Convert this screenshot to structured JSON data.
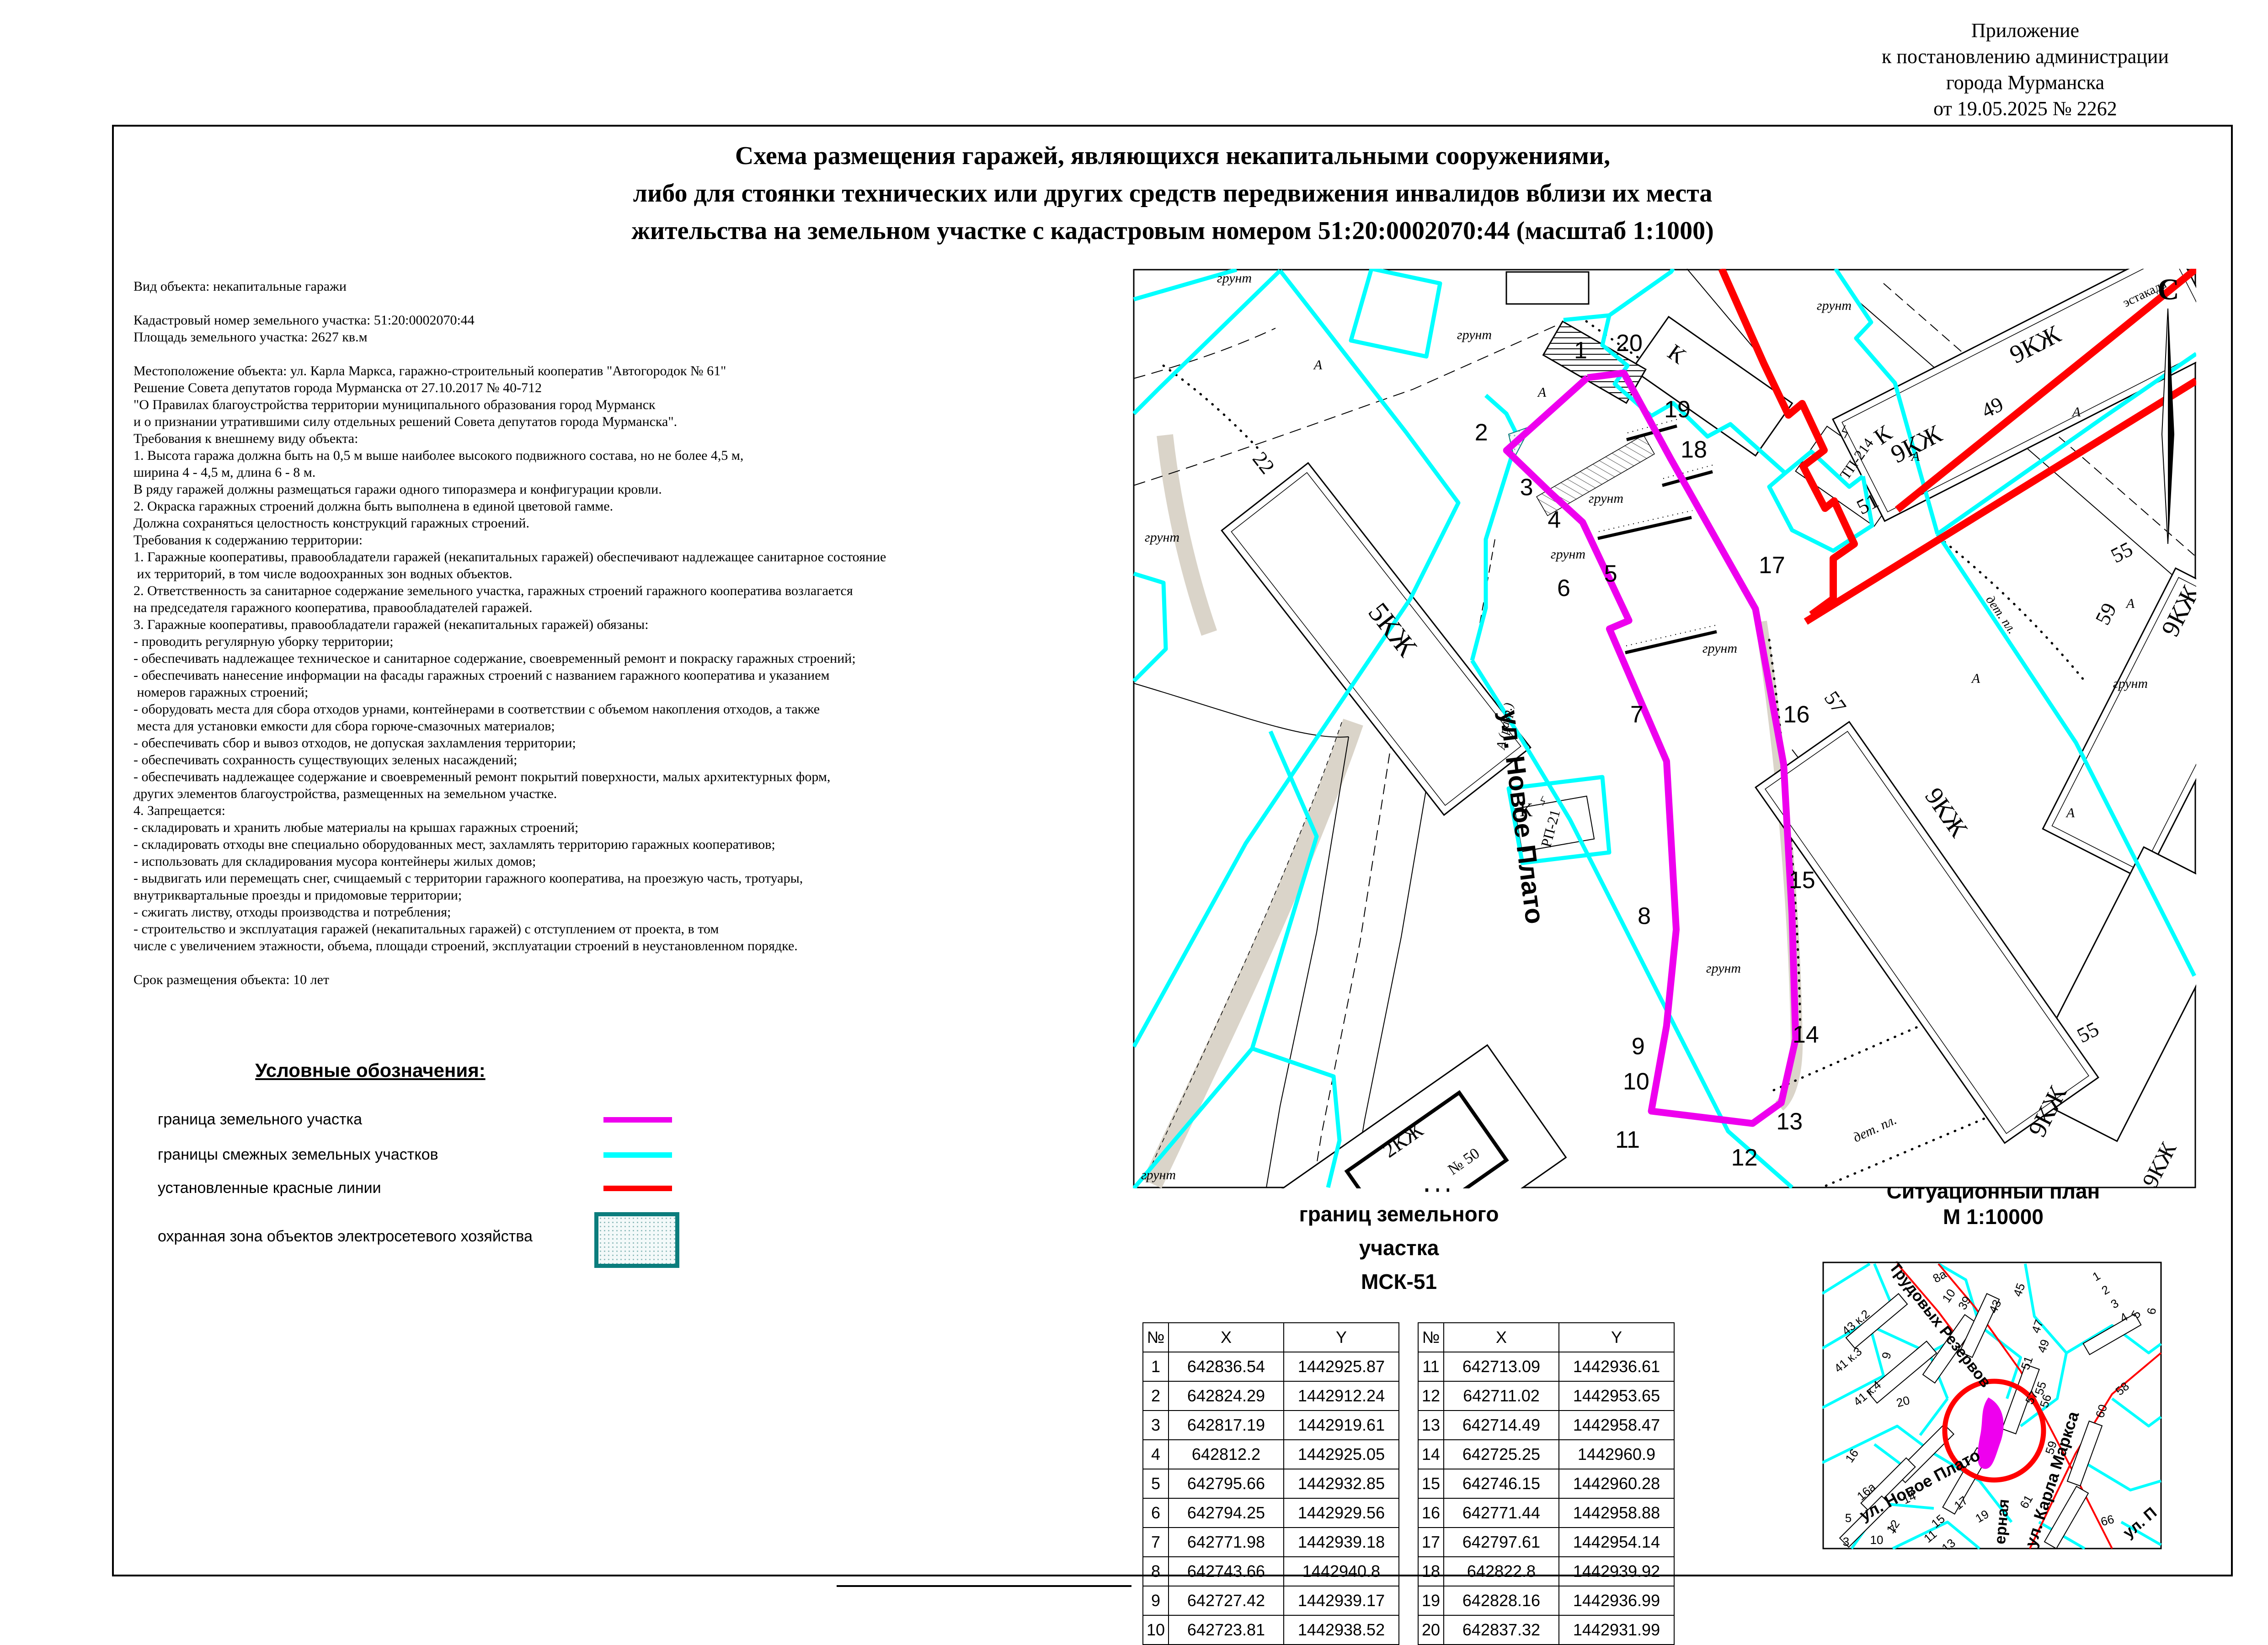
{
  "appendix": {
    "lines": [
      "Приложение",
      "к постановлению администрации",
      "города Мурманска",
      "от 19.05.2025 № 2262"
    ]
  },
  "title": {
    "lines": [
      "Схема размещения гаражей, являющихся некапитальными сооружениями,",
      "либо для стоянки технических или других средств передвижения инвалидов вблизи их места",
      "жительства на земельном участке с кадастровым номером 51:20:0002070:44 (масштаб 1:1000)"
    ]
  },
  "info_block": {
    "lines": [
      "Вид объекта: некапитальные гаражи",
      "",
      "Кадастровый номер земельного участка: 51:20:0002070:44",
      "Площадь земельного участка: 2627 кв.м",
      "",
      "Местоположение объекта: ул. Карла Маркса, гаражно-строительный кооператив \"Автогородок № 61\"",
      "Решение Совета депутатов города Мурманска от 27.10.2017 № 40-712",
      "\"О Правилах благоустройства территории муниципального образования город Мурманск",
      "и о признании утратившими силу отдельных решений Совета депутатов города Мурманска\".",
      "Требования к внешнему виду объекта:",
      "1. Высота гаража должна быть на 0,5 м выше наиболее высокого подвижного состава, но не более 4,5 м,",
      "ширина 4 - 4,5 м, длина 6 - 8 м.",
      "В ряду гаражей должны размещаться гаражи одного типоразмера и конфигурации кровли.",
      "2. Окраска гаражных строений должна быть выполнена в единой цветовой гамме.",
      "Должна сохраняться целостность конструкций гаражных строений.",
      "Требования к содержанию территории:",
      "1. Гаражные кооперативы, правообладатели гаражей (некапитальных гаражей) обеспечивают надлежащее санитарное состояние",
      " их территорий, в том числе водоохранных зон водных объектов.",
      "2. Ответственность за санитарное содержание земельного участка, гаражных строений гаражного кооператива возлагается",
      "на председателя гаражного кооператива, правообладателей гаражей.",
      "3. Гаражные кооперативы, правообладатели гаражей (некапитальных гаражей) обязаны:",
      "- проводить регулярную уборку территории;",
      "- обеспечивать надлежащее техническое и санитарное содержание, своевременный ремонт и покраску гаражных строений;",
      "- обеспечивать нанесение информации на фасады гаражных строений с названием гаражного кооператива и указанием",
      " номеров гаражных строений;",
      "- оборудовать места для сбора отходов урнами, контейнерами в соответствии с объемом накопления отходов, а также",
      " места для установки емкости для сбора горюче-смазочных материалов;",
      "- обеспечивать сбор и вывоз отходов, не допуская захламления территории;",
      "- обеспечивать сохранность существующих зеленых насаждений;",
      "- обеспечивать надлежащее содержание и своевременный ремонт покрытий поверхности, малых архитектурных форм,",
      "других элементов благоустройства, размещенных на земельном участке.",
      "4. Запрещается:",
      "- складировать и хранить любые материалы на крышах гаражных строений;",
      "- складировать отходы вне специально оборудованных мест, захламлять территорию гаражных кооперативов;",
      "- использовать для складирования мусора контейнеры жилых домов;",
      "- выдвигать или перемещать снег, счищаемый с территории гаражного кооператива, на проезжую часть, тротуары,",
      "внутриквартальные проезды и придомовые территории;",
      "- сжигать листву, отходы производства и потребления;",
      "- строительство и эксплуатация гаражей (некапитальных гаражей) с отступлением от проекта, в том",
      "числе с увеличением этажности, объема, площади строений, эксплуатации строений в неустановленном порядке.",
      "",
      "Срок размещения объекта: 10 лет"
    ]
  },
  "legend": {
    "title": "Условные обозначения:",
    "items": [
      {
        "label": "граница земельного участка",
        "type": "parcel-boundary",
        "color": "#ee00ee"
      },
      {
        "label": "границы смежных земельных участков",
        "type": "adjacent-boundaries",
        "color": "#00ffff"
      },
      {
        "label": "установленные красные линии",
        "type": "red-lines",
        "color": "#ff0000"
      },
      {
        "label": "охранная зона объектов электросетевого хозяйства",
        "type": "protection-zone",
        "color": "#0b7d7d"
      }
    ]
  },
  "coordinates": {
    "title_lines": [
      "Каталог координат",
      "границ земельного",
      "участка",
      "МСК-51"
    ],
    "col_headers": [
      "№",
      "X",
      "Y"
    ],
    "points": [
      {
        "n": 1,
        "x": "642836.54",
        "y": "1442925.87"
      },
      {
        "n": 2,
        "x": "642824.29",
        "y": "1442912.24"
      },
      {
        "n": 3,
        "x": "642817.19",
        "y": "1442919.61"
      },
      {
        "n": 4,
        "x": "642812.2",
        "y": "1442925.05"
      },
      {
        "n": 5,
        "x": "642795.66",
        "y": "1442932.85"
      },
      {
        "n": 6,
        "x": "642794.25",
        "y": "1442929.56"
      },
      {
        "n": 7,
        "x": "642771.98",
        "y": "1442939.18"
      },
      {
        "n": 8,
        "x": "642743.66",
        "y": "1442940.8"
      },
      {
        "n": 9,
        "x": "642727.42",
        "y": "1442939.17"
      },
      {
        "n": 10,
        "x": "642723.81",
        "y": "1442938.52"
      },
      {
        "n": 11,
        "x": "642713.09",
        "y": "1442936.61"
      },
      {
        "n": 12,
        "x": "642711.02",
        "y": "1442953.65"
      },
      {
        "n": 13,
        "x": "642714.49",
        "y": "1442958.47"
      },
      {
        "n": 14,
        "x": "642725.25",
        "y": "1442960.9"
      },
      {
        "n": 15,
        "x": "642746.15",
        "y": "1442960.28"
      },
      {
        "n": 16,
        "x": "642771.44",
        "y": "1442958.88"
      },
      {
        "n": 17,
        "x": "642797.61",
        "y": "1442954.14"
      },
      {
        "n": 18,
        "x": "642822.8",
        "y": "1442939.92"
      },
      {
        "n": 19,
        "x": "642828.16",
        "y": "1442936.99"
      },
      {
        "n": 20,
        "x": "642837.32",
        "y": "1442931.99"
      }
    ]
  },
  "map": {
    "labels": [
      [
        "грунт",
        2700,
        618,
        0,
        30,
        "si"
      ],
      [
        "грунт",
        3225,
        742,
        0,
        30,
        "si"
      ],
      [
        "грунт",
        2542,
        1185,
        0,
        30,
        "si"
      ],
      [
        "грунт",
        4012,
        678,
        0,
        30,
        "si"
      ],
      [
        "грунт",
        3513,
        1100,
        0,
        30,
        "si"
      ],
      [
        "грунт",
        3430,
        1222,
        0,
        30,
        "si"
      ],
      [
        "грунт",
        3770,
        2128,
        0,
        30,
        "si"
      ],
      [
        "грунт",
        2534,
        2580,
        0,
        30,
        "si"
      ],
      [
        "грунт",
        4660,
        1505,
        0,
        30,
        "si"
      ],
      [
        "грунт",
        3762,
        1428,
        0,
        30,
        "si"
      ],
      [
        "А",
        2883,
        808,
        0,
        30,
        "si"
      ],
      [
        "А",
        3373,
        868,
        0,
        30,
        "si"
      ],
      [
        "А",
        4542,
        911,
        0,
        30,
        "si"
      ],
      [
        "А",
        4190,
        1008,
        0,
        30,
        "si"
      ],
      [
        "А",
        4322,
        1494,
        0,
        30,
        "si"
      ],
      [
        "А",
        4529,
        1788,
        0,
        30,
        "si"
      ],
      [
        "А",
        4660,
        1330,
        0,
        30,
        "si"
      ],
      [
        "А (разр.)",
        3300,
        1590,
        -80,
        28,
        "si"
      ],
      [
        "С",
        4743,
        655,
        0,
        66,
        "sb"
      ],
      [
        "эстакада",
        4695,
        650,
        -26,
        28,
        "s"
      ],
      [
        "5КЖ",
        3030,
        1390,
        52,
        62,
        "s"
      ],
      [
        "22",
        2752,
        1022,
        52,
        46,
        "s"
      ],
      [
        "К",
        3658,
        788,
        35,
        50,
        "s"
      ],
      [
        "К",
        4128,
        965,
        -35,
        50,
        "s"
      ],
      [
        "ТП-214",
        4070,
        1010,
        -55,
        32,
        "s"
      ],
      [
        "К",
        3338,
        1786,
        0,
        42,
        "s"
      ],
      [
        "РП-21",
        3402,
        1815,
        -75,
        32,
        "s"
      ],
      [
        "ϟ",
        4032,
        958,
        15,
        40,
        "s"
      ],
      [
        "ϟ",
        3372,
        1762,
        15,
        30,
        "s"
      ],
      [
        "9КЖ",
        4460,
        770,
        -27,
        56,
        "s"
      ],
      [
        "9КЖ",
        4200,
        988,
        -27,
        56,
        "s"
      ],
      [
        "9КЖ",
        4786,
        1345,
        -63,
        56,
        "s"
      ],
      [
        "9КЖ",
        4495,
        2440,
        -63,
        56,
        "s"
      ],
      [
        "9КЖ",
        4242,
        1788,
        55,
        56,
        "s"
      ],
      [
        "9КЖ",
        4738,
        2556,
        -63,
        50,
        "s"
      ],
      [
        "49",
        4365,
        905,
        -27,
        46,
        "s"
      ],
      [
        "51",
        4092,
        1116,
        -27,
        46,
        "s"
      ],
      [
        "55",
        4648,
        1222,
        -27,
        46,
        "s"
      ],
      [
        "55",
        4574,
        2272,
        -27,
        46,
        "s"
      ],
      [
        "57",
        4002,
        1545,
        55,
        46,
        "s"
      ],
      [
        "59",
        4620,
        1350,
        -63,
        46,
        "s"
      ],
      [
        "2КЖ",
        3077,
        2507,
        -35,
        46,
        "s"
      ],
      [
        "№ 50",
        3208,
        2550,
        -35,
        34,
        "s"
      ],
      [
        "дет. пл.",
        4370,
        1350,
        55,
        28,
        "si"
      ],
      [
        "дет. пл.",
        4105,
        2478,
        -25,
        30,
        "si"
      ],
      [
        "ул. Новое Плато",
        3310,
        1790,
        83,
        58,
        "b"
      ]
    ]
  },
  "situational_plan": {
    "title_lines": [
      "Ситуационный план",
      "М 1:10000"
    ],
    "labels": [
      [
        "Трудовых Резервов",
        4235,
        2905,
        52,
        34,
        "b"
      ],
      [
        "ул. Новое Плато",
        4205,
        3260,
        -28,
        36,
        "b"
      ],
      [
        "ул. Карла Маркса",
        4500,
        3240,
        -72,
        36,
        "b"
      ],
      [
        "ерная",
        4390,
        3330,
        -85,
        34,
        "b"
      ],
      [
        "ул. П",
        4688,
        3340,
        -40,
        34,
        "b"
      ],
      [
        "43 к.2",
        4065,
        2900,
        -40,
        26,
        "n"
      ],
      [
        "41 к.3",
        4048,
        2982,
        -40,
        26,
        "n"
      ],
      [
        "41 к.4",
        4090,
        3055,
        -40,
        26,
        "n"
      ],
      [
        "9",
        4135,
        2968,
        -75,
        26,
        "n"
      ],
      [
        "20",
        4165,
        3075,
        -15,
        26,
        "n"
      ],
      [
        "16",
        4058,
        3190,
        -55,
        26,
        "n"
      ],
      [
        "16а",
        4088,
        3270,
        -40,
        26,
        "n"
      ],
      [
        "14",
        4180,
        3285,
        -25,
        26,
        "n"
      ],
      [
        "12",
        4148,
        3345,
        -55,
        26,
        "n"
      ],
      [
        "10",
        4105,
        3378,
        0,
        26,
        "n"
      ],
      [
        "5",
        4043,
        3330,
        0,
        26,
        "n"
      ],
      [
        "3",
        4038,
        3382,
        0,
        26,
        "n"
      ],
      [
        "8а",
        4247,
        2800,
        -30,
        26,
        "n"
      ],
      [
        "10",
        4270,
        2840,
        -55,
        26,
        "n"
      ],
      [
        "39",
        4305,
        2855,
        -60,
        26,
        "n"
      ],
      [
        "43",
        4372,
        2862,
        -65,
        26,
        "n"
      ],
      [
        "45",
        4425,
        2825,
        -70,
        26,
        "n"
      ],
      [
        "47",
        4465,
        2905,
        -70,
        26,
        "n"
      ],
      [
        "49",
        4478,
        2948,
        -70,
        26,
        "n"
      ],
      [
        "51",
        4442,
        2985,
        -70,
        26,
        "n"
      ],
      [
        "57",
        4452,
        3062,
        -60,
        26,
        "n"
      ],
      [
        "55",
        4472,
        3040,
        -72,
        26,
        "n"
      ],
      [
        "56",
        4483,
        3068,
        -72,
        26,
        "n"
      ],
      [
        "59",
        4495,
        3170,
        -72,
        26,
        "n"
      ],
      [
        "61",
        4440,
        3290,
        -60,
        26,
        "n"
      ],
      [
        "19",
        4340,
        3325,
        -30,
        26,
        "n"
      ],
      [
        "17",
        4295,
        3295,
        -40,
        26,
        "n"
      ],
      [
        "15",
        4245,
        3335,
        -40,
        26,
        "n"
      ],
      [
        "13",
        4268,
        3388,
        -40,
        26,
        "n"
      ],
      [
        "11",
        4228,
        3368,
        -40,
        26,
        "n"
      ],
      [
        "7",
        4148,
        3352,
        -45,
        26,
        "n"
      ],
      [
        "66",
        4612,
        3335,
        -15,
        26,
        "n"
      ],
      [
        "60",
        4605,
        3090,
        -72,
        26,
        "n"
      ],
      [
        "58",
        4648,
        3045,
        -40,
        26,
        "n"
      ],
      [
        "1",
        4590,
        2800,
        -30,
        26,
        "n"
      ],
      [
        "2",
        4610,
        2830,
        -30,
        26,
        "n"
      ],
      [
        "3",
        4630,
        2860,
        -30,
        26,
        "n"
      ],
      [
        "4",
        4650,
        2890,
        -30,
        26,
        "n"
      ],
      [
        "5",
        4680,
        2880,
        -60,
        26,
        "n"
      ],
      [
        "6",
        4715,
        2870,
        -80,
        26,
        "n"
      ]
    ]
  },
  "colors": {
    "parcel": "#ee00ee",
    "adjacent": "#00ffff",
    "red_line": "#ff0000",
    "zone_border": "#0b7d7d",
    "slope": "#d8d2c6"
  }
}
